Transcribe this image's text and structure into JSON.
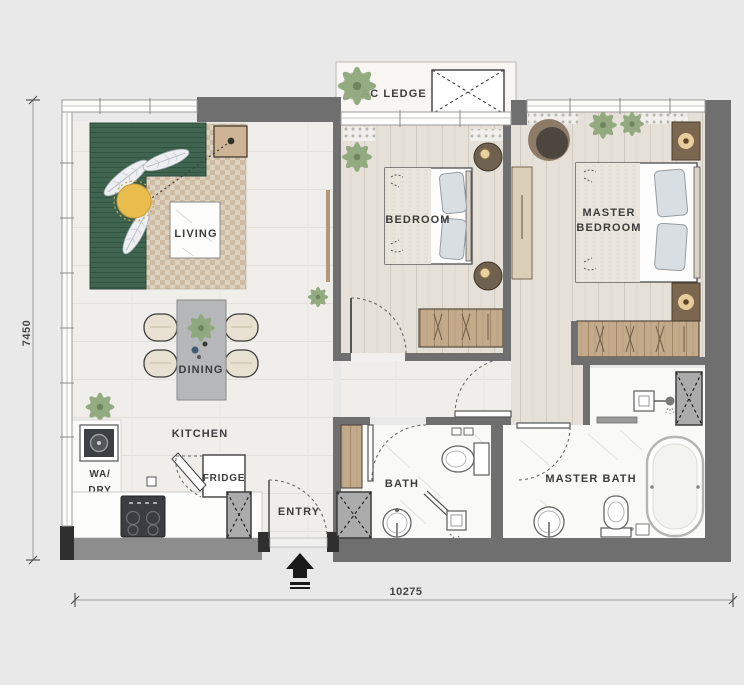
{
  "labels": {
    "living": "LIVING",
    "dining": "DINING",
    "kitchen": "KITCHEN",
    "entry": "ENTRY",
    "bath": "BATH",
    "master_bath": "MASTER BATH",
    "bedroom": "BEDROOM",
    "master_bedroom_1": "MASTER",
    "master_bedroom_2": "BEDROOM",
    "wa_dry_1": "WA/",
    "wa_dry_2": "DRY",
    "fridge": "FRIDGE",
    "ac_ledge": "AC LEDGE"
  },
  "dimensions": {
    "horizontal": "10275",
    "vertical": "7450"
  },
  "colors": {
    "background": "#e9e9e9",
    "wall": "#6f6f6f",
    "wall_light": "#8d8d8d",
    "wall_dark": "#2f2f2f",
    "floor_tile": "#efeeeb",
    "floor_wood": "#e5e0d8",
    "floor_marble": "#f9f9f8",
    "sofa_green": "#3f6450",
    "pouf_yellow": "#e8bd4d",
    "rug_light": "#ddd2bf",
    "rug_dark": "#cdbba3",
    "plant_green": "#8fa87c",
    "plant_dark": "#6d855c",
    "wood_cabinet": "#b1916d",
    "wood_furniture": "#c3aa8b",
    "wood_light": "#dccfba",
    "label_text": "#3c3c3c"
  }
}
